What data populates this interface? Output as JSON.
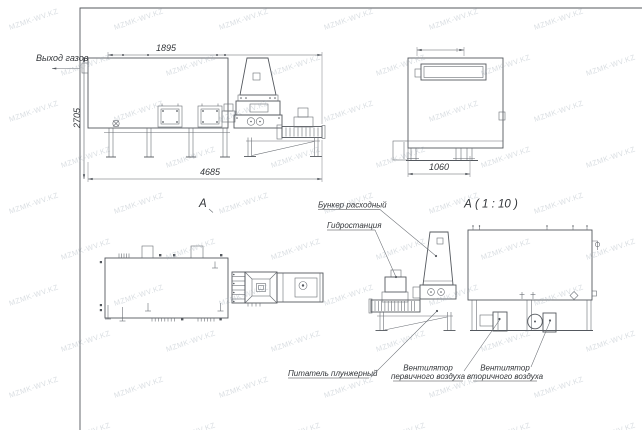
{
  "watermark": {
    "text": "MZMK-WV.KZ"
  },
  "side_view": {
    "gas_outlet_label": "Выход газов",
    "dim_top": "1895",
    "dim_left": "2705",
    "dim_bottom": "4685",
    "section_mark": "А"
  },
  "end_view": {
    "dim_bottom": "1060"
  },
  "detail_view": {
    "title": "А ( 1 : 10 )"
  },
  "callouts": {
    "hopper": "Бункер расходный",
    "hydraulic": "Гидростанция",
    "feeder": "Питатель плунжерный",
    "fan_primary_line1": "Вентилятор",
    "fan_primary_line2": "первичного воздуха",
    "fan_secondary_line1": "Вентилятор",
    "fan_secondary_line2": "вторичного воздуха"
  },
  "colors": {
    "line": "#54585e",
    "text": "#33363a",
    "watermark": "#93a0ac",
    "background": "#ffffff"
  }
}
